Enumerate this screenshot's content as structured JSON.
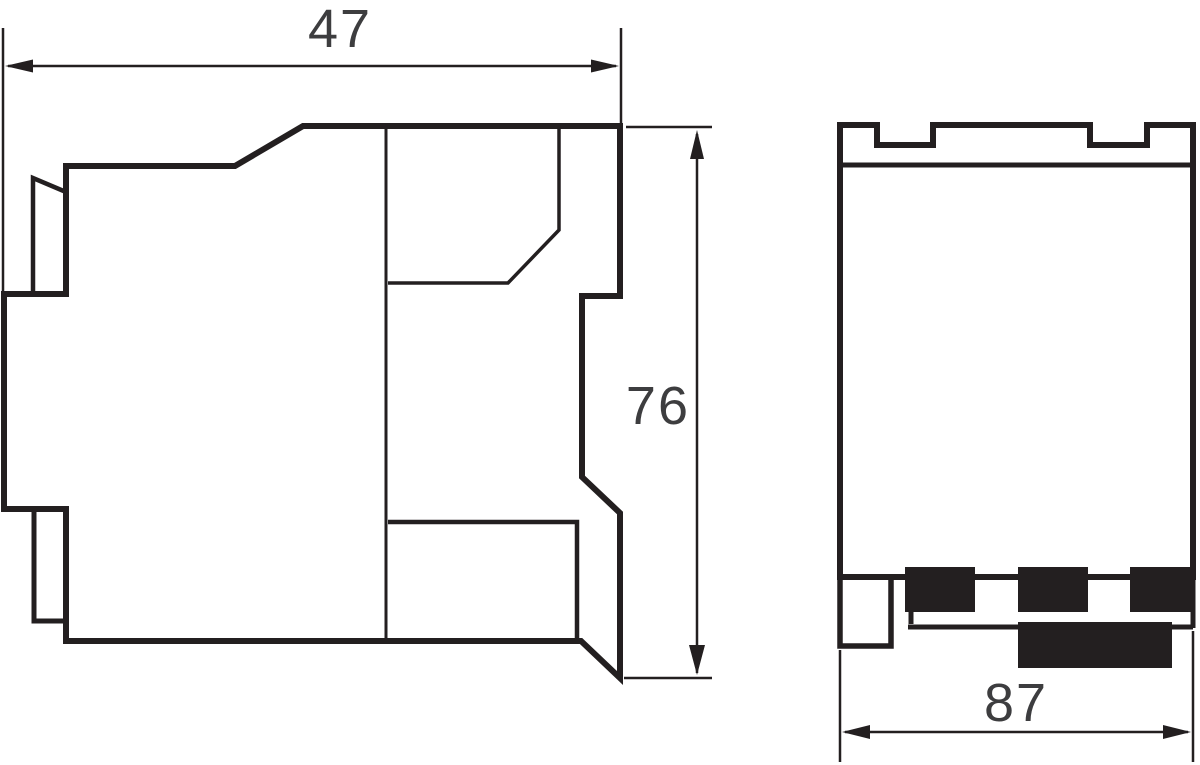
{
  "drawing": {
    "colors": {
      "line": "#231f20",
      "fill": "#231f20",
      "text": "#3d3d3f",
      "background": "#ffffff"
    },
    "dimensions": {
      "side_width": "47",
      "side_height": "76",
      "front_width": "87"
    }
  }
}
